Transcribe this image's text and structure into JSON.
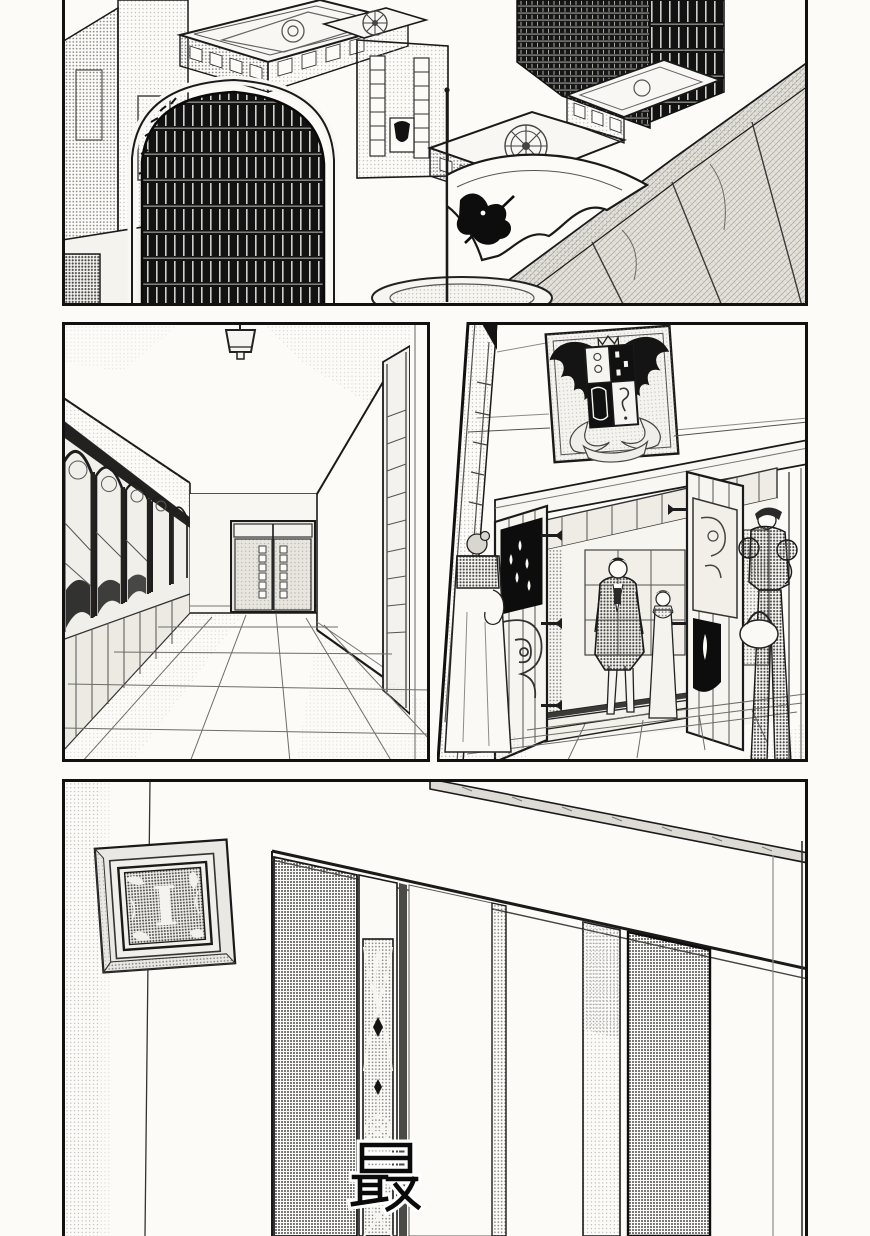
{
  "page": {
    "type": "manga-page",
    "orientation": "portrait",
    "paper_color": "#fcfbf8",
    "ink_color": "#1a1a1a",
    "halftone_color": "#8a8a8a"
  },
  "texts": {
    "plaque_letter": "I",
    "caption_kanji": "最"
  },
  "panels": [
    {
      "name": "aerial-city-view",
      "description": "Isometric aerial view of ornate stone buildings with decorative rooftop wheel emblems, a dark arched lattice gate, tall dark towers, a long perimeter wall and a white banner bearing a dark crest on a pole above a round plaza."
    },
    {
      "name": "hallway-interior",
      "description": "Long interior corridor in one-point perspective: hanging ceiling lamp, left wall lined with arched stained-glass windows, double door with small square panes at the far end, tiled floor."
    },
    {
      "name": "entrance-scene",
      "description": "Building entrance seen from outside: framed coat of arms with black wings on the wall above, heavy open wooden doors with ornate panels and hinges, steps, and four figures in period clothing including a woman with a basket."
    },
    {
      "name": "door-closeup",
      "description": "Close-up of a wall corner: beveled square plaque with an ornamental letter on the left wall, paneled sliding doors with a tall stained-glass strip receding to the right, caption character over the glass."
    }
  ],
  "motifs": [
    "coat-of-arms",
    "banner-flag",
    "wheel-emblem",
    "letter-plaque",
    "stained-glass-window",
    "ceiling-lamp",
    "arched-gate",
    "teardrop-door-panel"
  ],
  "colors": {
    "paper": "#fcfbf8",
    "ink": "#1a1a1a",
    "halftone_light": "#9a9a9a",
    "halftone_dark": "#4a4a4a",
    "black_fill": "#121212"
  }
}
